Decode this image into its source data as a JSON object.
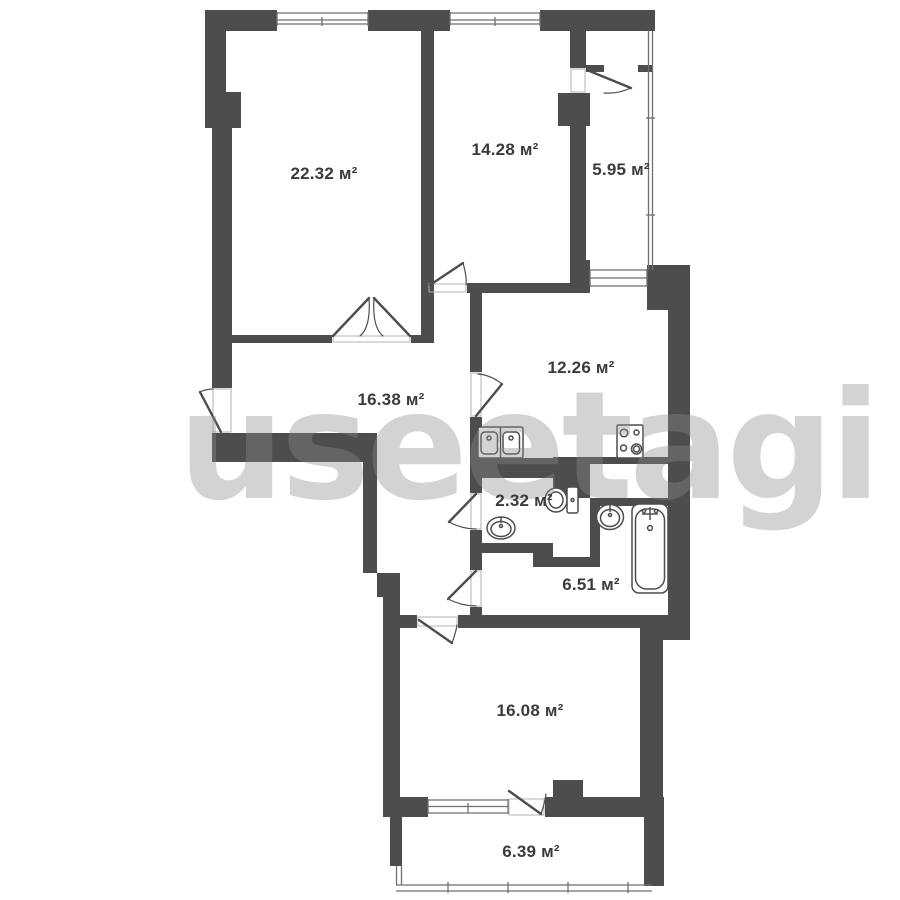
{
  "title": "apartment-floor-plan",
  "watermark": "useetagi",
  "unit_suffix": "м²",
  "colors": {
    "wall": "#4d4d4d",
    "line": "#4d4d4d",
    "window_line": "#6f6f6f",
    "threshold_line": "#b3b3b3",
    "background": "#ffffff",
    "label_text": "#3b3b3b",
    "watermark": "rgba(140,140,140,0.38)"
  },
  "rooms": [
    {
      "id": "living-room",
      "area_label": "22.32 м²"
    },
    {
      "id": "bedroom",
      "area_label": "14.28 м²"
    },
    {
      "id": "loggia",
      "area_label": "5.95 м²"
    },
    {
      "id": "hallway",
      "area_label": "16.38 м²"
    },
    {
      "id": "kitchen",
      "area_label": "12.26 м²"
    },
    {
      "id": "wc",
      "area_label": "2.32 м²"
    },
    {
      "id": "bathroom",
      "area_label": "6.51 м²"
    },
    {
      "id": "room-2",
      "area_label": "16.08 м²"
    },
    {
      "id": "balcony",
      "area_label": "6.39 м²"
    }
  ],
  "fixtures": [
    "kitchen-double-sink",
    "stove",
    "toilet",
    "wc-basin",
    "bathroom-round-sink",
    "bathtub"
  ]
}
